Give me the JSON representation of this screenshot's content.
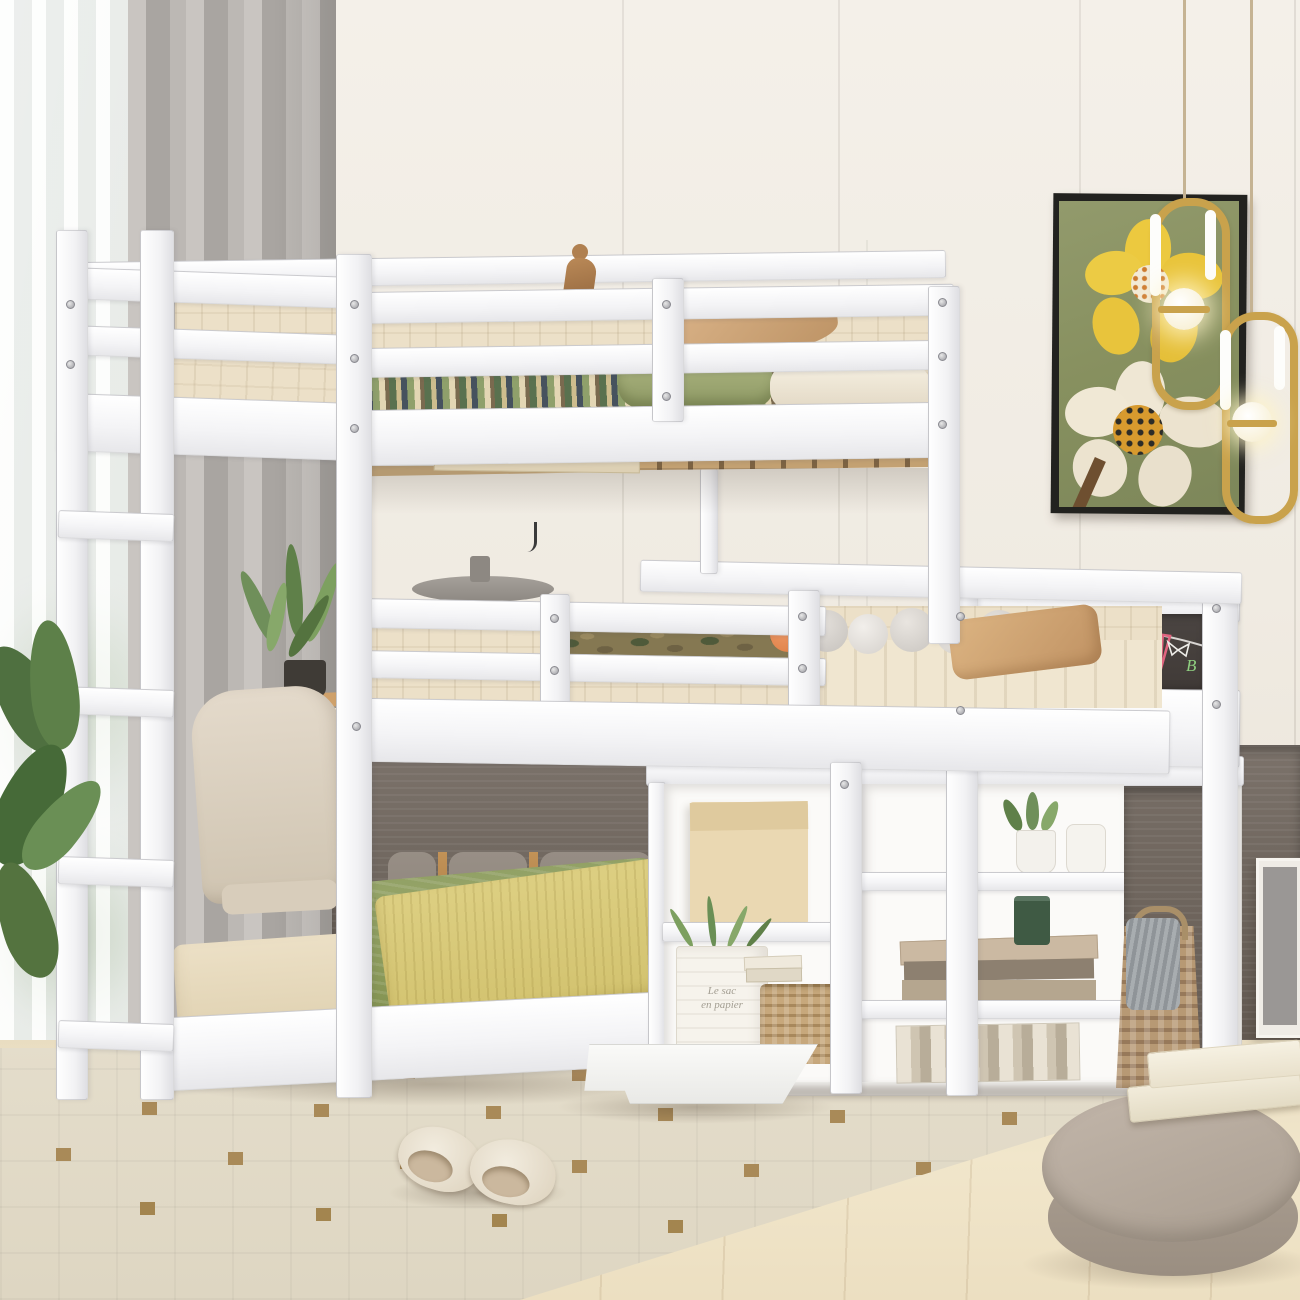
{
  "scene": {
    "type": "product-photo",
    "subject": "White wooden L-shaped triple bunk bed with ladder, guardrails, chalkboard end panel and open storage cabinet, staged in a bright kids bedroom",
    "texts": {
      "paper_bag_line1": "Le sac",
      "paper_bag_line2": "en papier",
      "chalk_letter": "B"
    },
    "objects": [
      "top-bunk-bed",
      "middle-bunk-bed",
      "bottom-floor-bed",
      "ladder",
      "guardrails",
      "chalkboard-panel",
      "storage-cabinet",
      "fold-down-cabinet-door",
      "wall-shelf-with-books",
      "wooden-figurine",
      "pompom-garland",
      "camo-blanket",
      "green-blanket",
      "yellow-fringe-throw",
      "flower-painting",
      "two-pendant-lamps",
      "sheer-curtain",
      "gray-drape",
      "potted-plant",
      "desk-and-chair",
      "gray-table-lamp",
      "paper-bag-planter",
      "wicker-baskets",
      "slippers",
      "round-pouf",
      "stacked-books",
      "area-rug",
      "wood-floor",
      "dark-wood-accent-wall"
    ],
    "palette": {
      "wall": "#f1ece3",
      "bed_white": "#fbfbfc",
      "mattress_cream": "#ece0c8",
      "green_blanket": "#8d9c60",
      "yellow_throw": "#d9c877",
      "tan_pillow": "#cfa06f",
      "chalkboard": "#46403c",
      "chalk_blue": "#7db4e2",
      "chalk_purple": "#a871cf",
      "chalk_pink": "#e0647f",
      "chalk_green": "#8fcf80",
      "wood_wall": "#6f665e",
      "brass": "#b5854e",
      "floor_wood": "#eee2c6",
      "rug": "#e2dbc9",
      "rug_motif": "#a98a58",
      "pouf": "#b3a79b",
      "basket_wicker": "#c0a274",
      "painting_canvas": "#8a9164",
      "painting_yellow": "#ecc93f",
      "painting_white": "#efe7d4",
      "lamp_gold": "#c9a24c",
      "plant_green": "#5f8049",
      "drape_gray": "#b2aeaa"
    }
  }
}
